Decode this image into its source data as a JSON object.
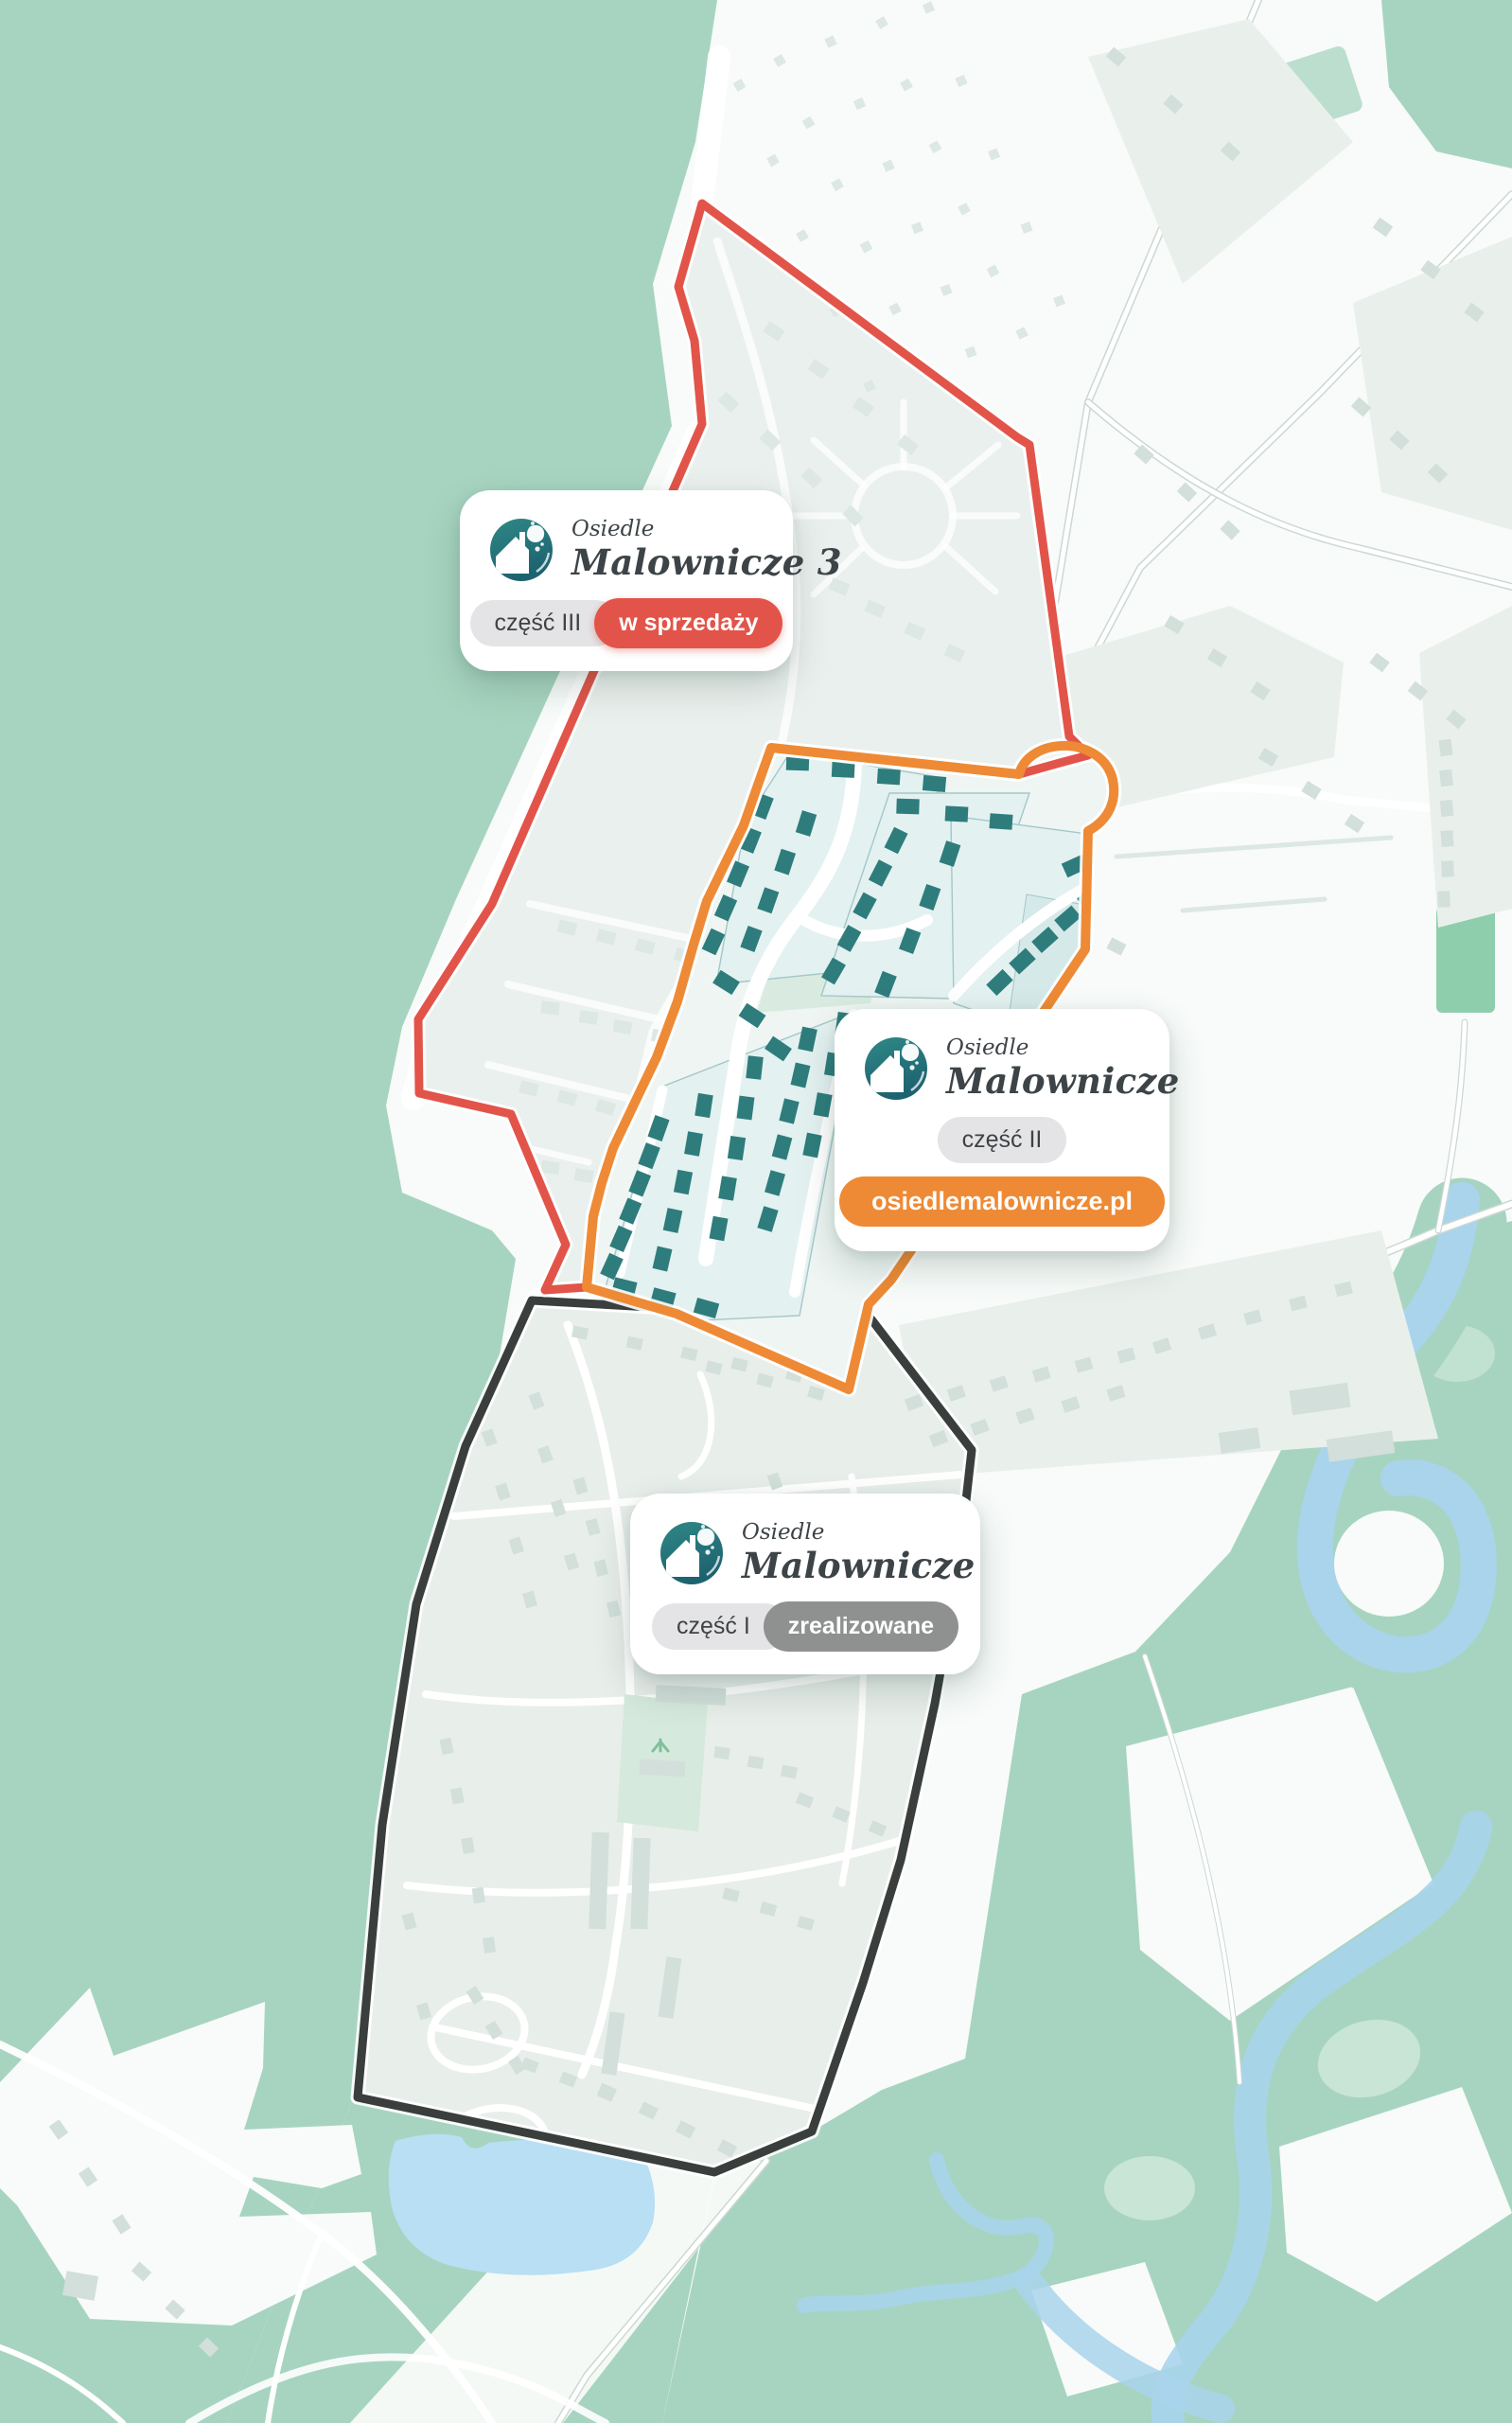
{
  "colors": {
    "teal": "#a7d4c0",
    "teal_bright": "#8fceac",
    "teal_light": "#c8e5d5",
    "white_field": "#f8fbf9",
    "parcel": "#e9f0ec",
    "building": "#d2dfda",
    "road_casing": "#ccd8d3",
    "pond": "#b8dff3",
    "river": "#a9d4ec",
    "stage3_fill": "#eaf0ed",
    "stage2_fill": "#eef5f3",
    "stage1_fill": "#e8eeea",
    "plot_fill": "#e4f1f1",
    "plot_stroke": "#a3c7c7",
    "plot_dark": "#d6e9e9",
    "park": "#d5e9dc",
    "house_teal": "#2e7d7c",
    "ghost": "#dde7e3",
    "red": "#e25449",
    "orange": "#ee8a35",
    "black": "#3a3f3e",
    "pill_gray_bg": "#e4e4e6",
    "pill_dark_bg": "#8f9191",
    "logo_teal_top": "#2f8886",
    "logo_teal_bottom": "#1d6270",
    "brand_text": "#3d4447"
  },
  "icons": {
    "brand_logo": "globe-house-icon"
  },
  "cards": {
    "part3": {
      "brand_top": "Osiedle",
      "brand": "Malownicze 3",
      "stage_label": "część III",
      "status_label": "w sprzedaży"
    },
    "part2": {
      "brand_top": "Osiedle",
      "brand": "Malownicze",
      "stage_label": "część II",
      "link_label": "osiedlemalownicze.pl"
    },
    "part1": {
      "brand_top": "Osiedle",
      "brand": "Malownicze",
      "stage_label": "część I",
      "status_label": "zrealizowane"
    }
  }
}
